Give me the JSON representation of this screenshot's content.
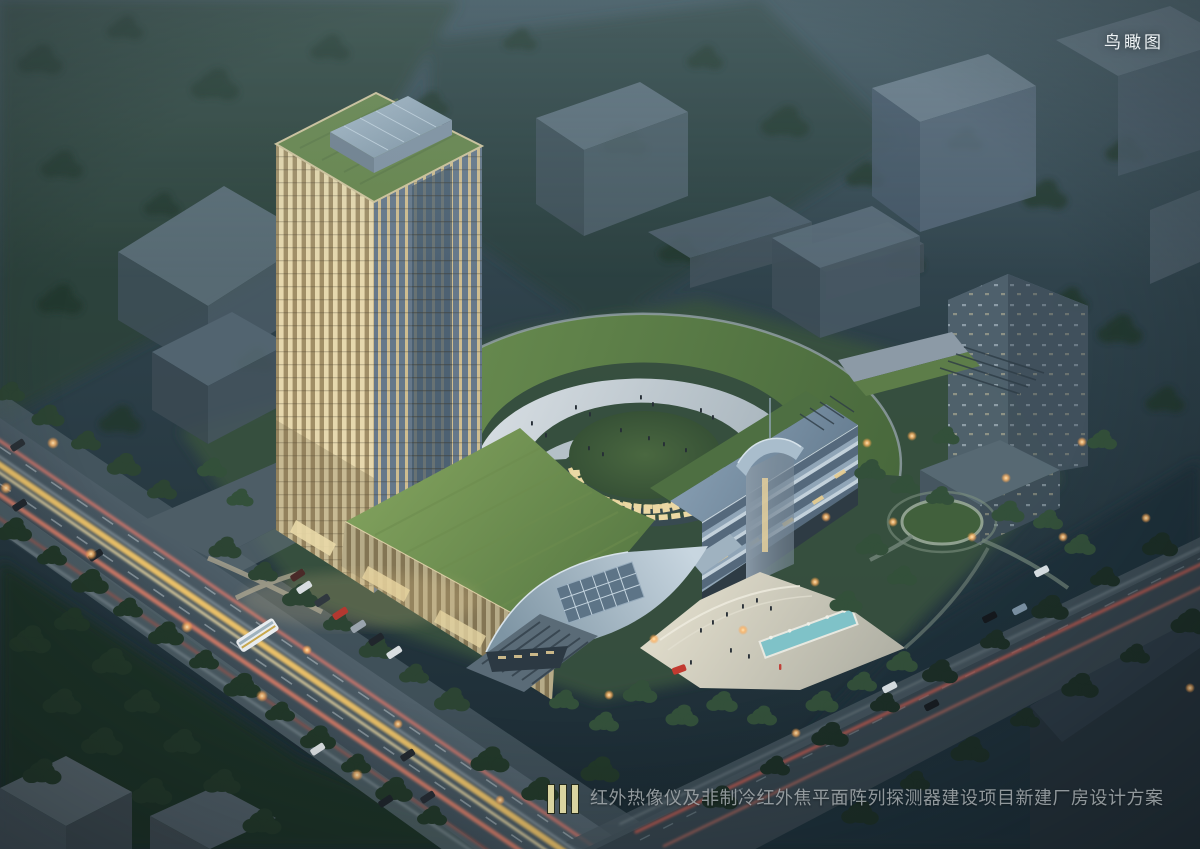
{
  "scene": {
    "type": "architectural aerial rendering at dusk",
    "view_label": "鸟瞰图",
    "caption": "红外热像仪及非制冷红外焦平面阵列探测器建设项目新建厂房设计方案"
  },
  "palette": {
    "sky_teal": "#31444d",
    "tower_fins_warm": "#e6d8ae",
    "glass_blue": "#6b7d8d",
    "green_roof": "#6c8f52",
    "lawn_dark": "#2c4138",
    "road_asphalt": "#46565f",
    "headlight_trail": "#f4c76a",
    "taillight_trail": "#d4776b",
    "pool": "#7fc2c8",
    "caption_text": "#a2a8ac",
    "logo_bar": "#d9d4a0"
  }
}
